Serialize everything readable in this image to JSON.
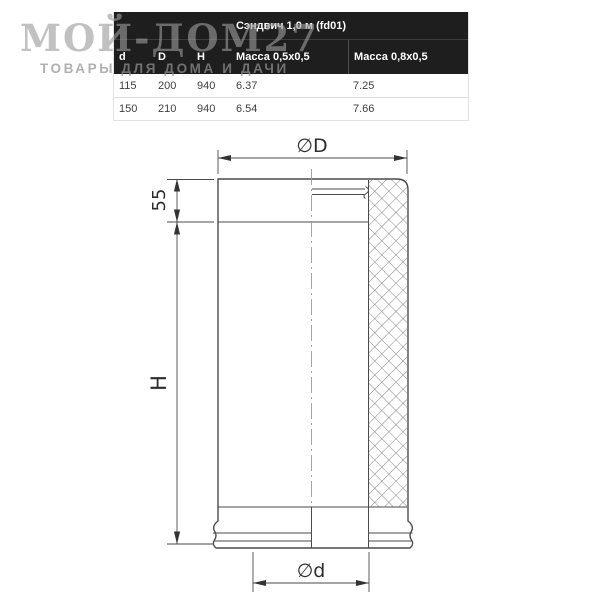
{
  "watermark": {
    "title": "МОЙ-ДОМ27",
    "subtitle": "ТОВАРЫ ДЛЯ ДОМА И ДАЧИ"
  },
  "table": {
    "title": "Сэндвич 1,0 м (fd01)",
    "columns": [
      "d",
      "D",
      "H",
      "Масса 0,5x0,5",
      "Масса 0,8x0,5"
    ],
    "rows": [
      [
        "115",
        "200",
        "940",
        "6.37",
        "7.25"
      ],
      [
        "150",
        "210",
        "940",
        "6.54",
        "7.66"
      ]
    ]
  },
  "drawing": {
    "labels": {
      "outer_diameter": "∅D",
      "collar_height": "55",
      "height": "H",
      "inner_diameter": "∅d"
    }
  },
  "colors": {
    "table_header_bg": "#1e1e1e",
    "table_text": "#3f3f3f",
    "drawing_line": "#4a4a4a",
    "centerline": "#9b9b9b",
    "watermark": "#9b9b9b"
  }
}
